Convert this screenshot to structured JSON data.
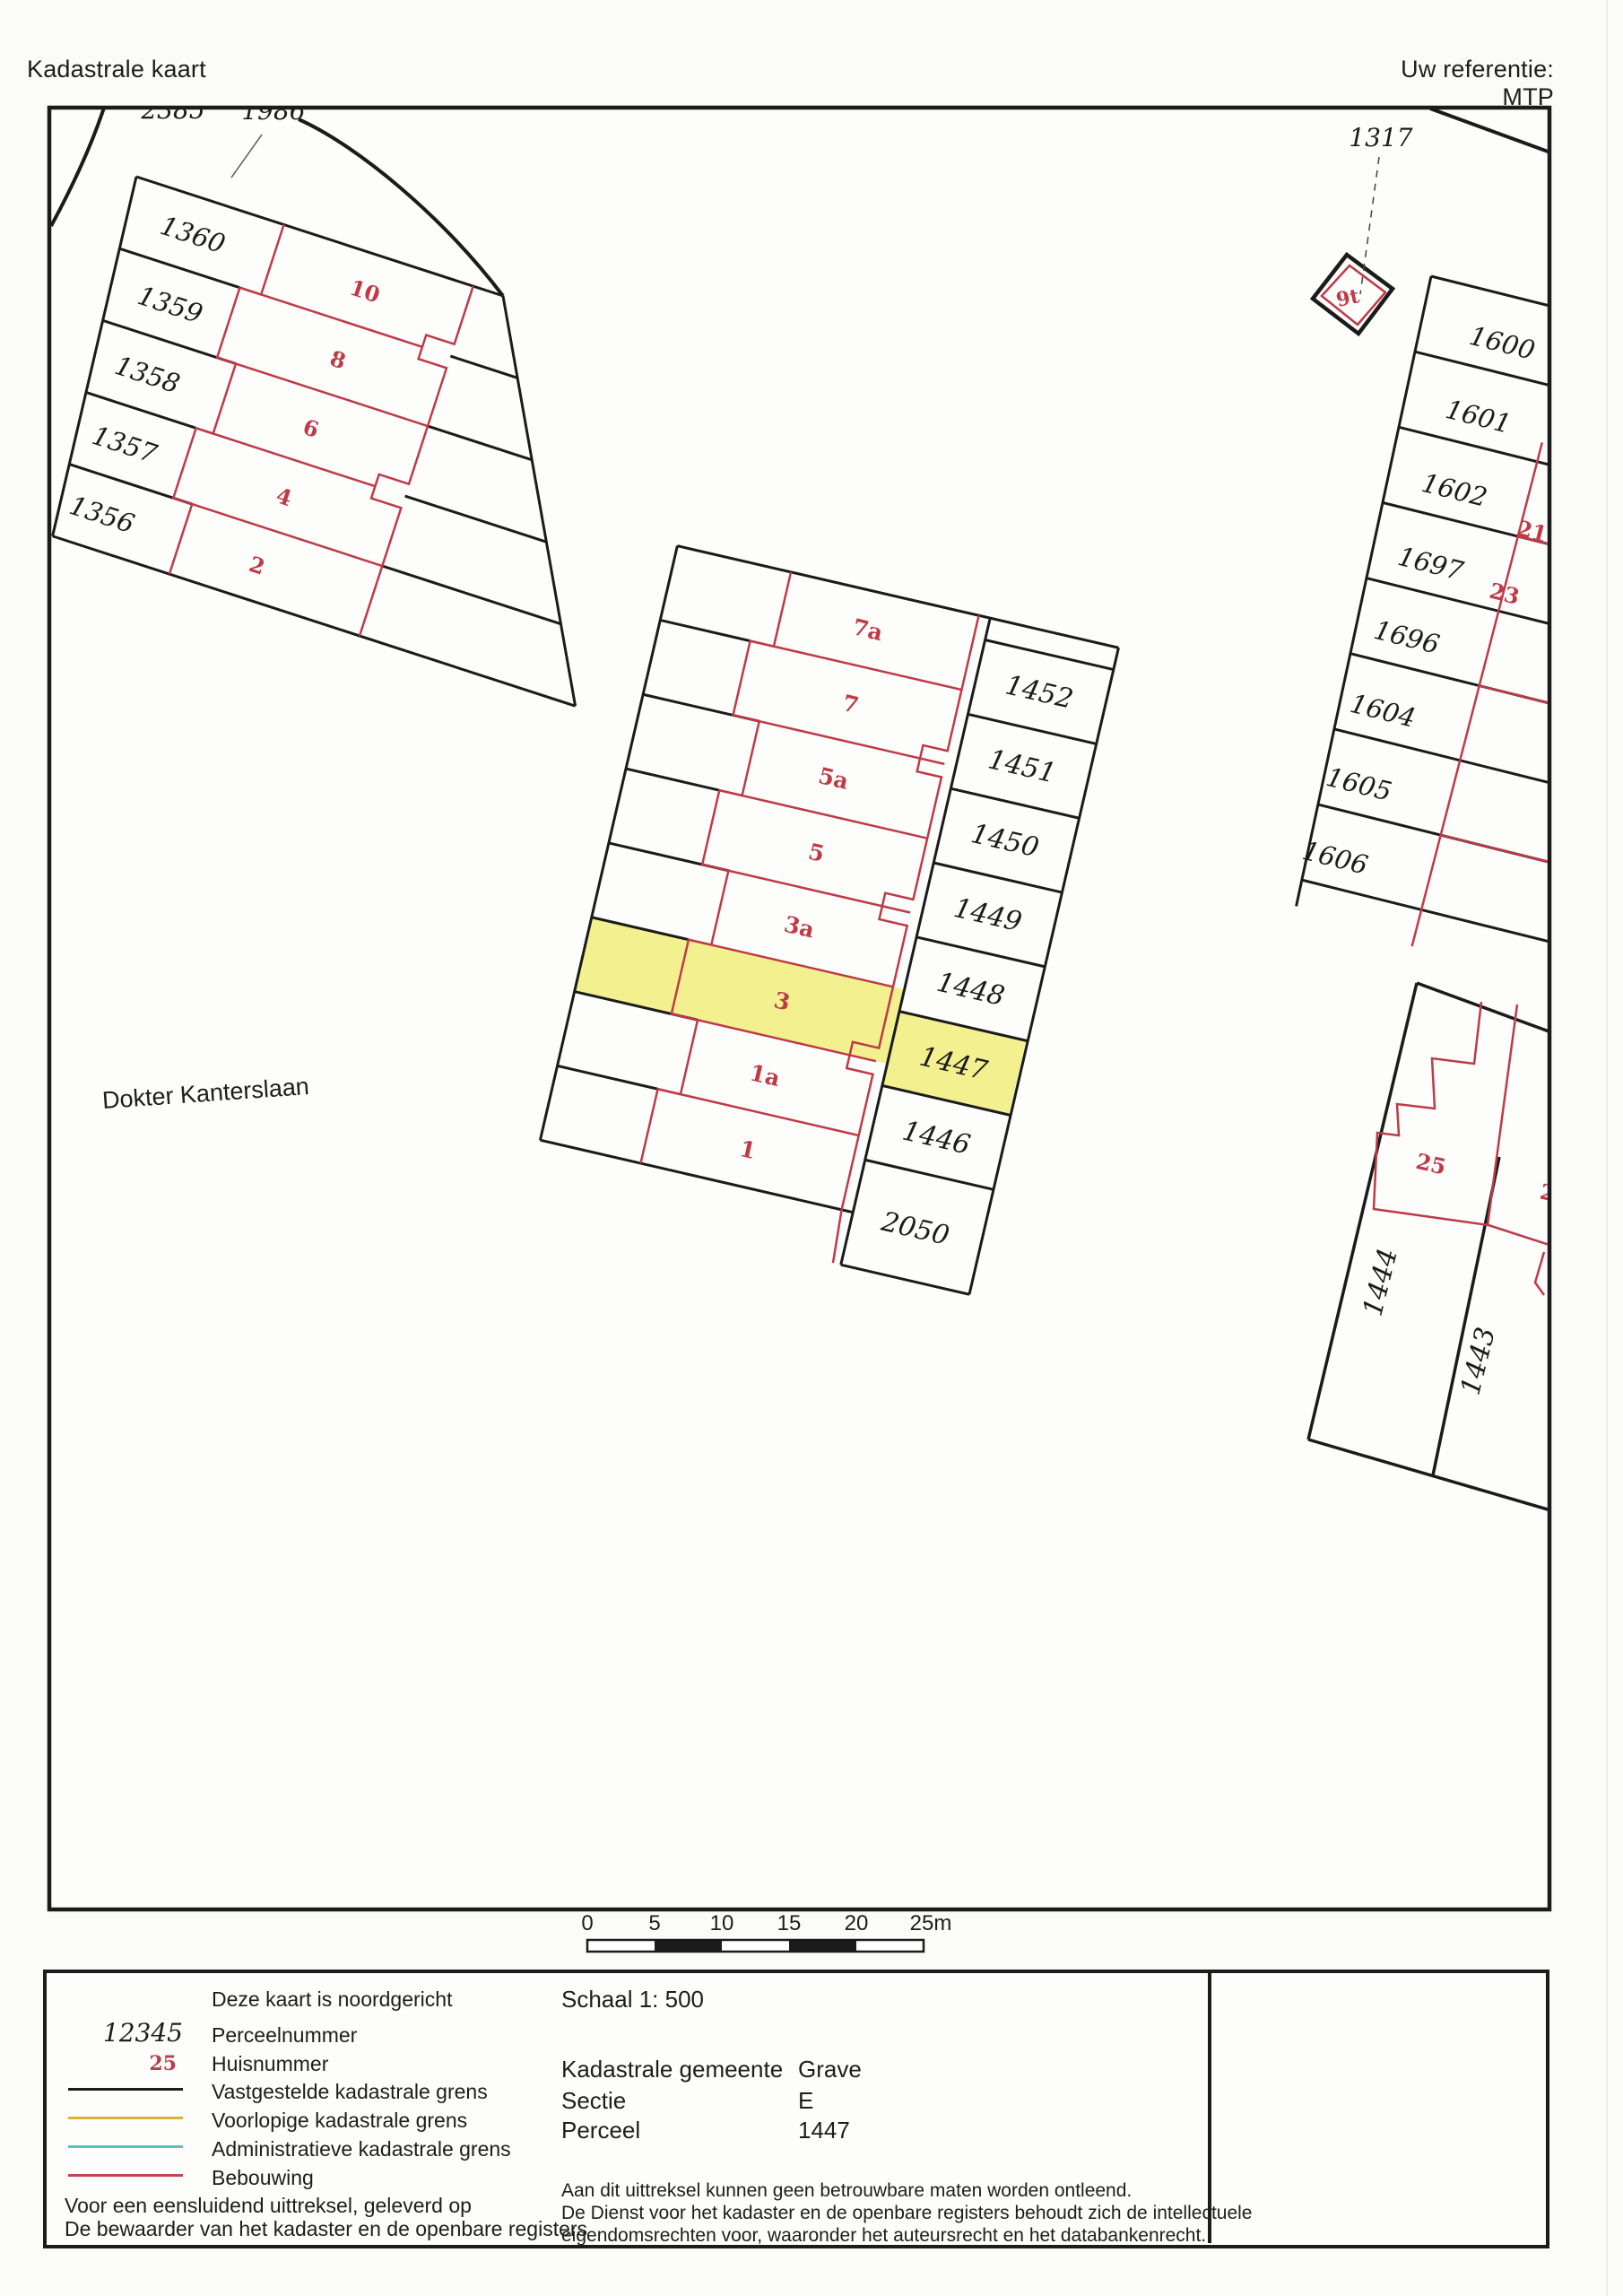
{
  "header": {
    "title": "Kadastrale kaart",
    "reference": "Uw referentie: MTP"
  },
  "map": {
    "street": "Dokter Kanterslaan",
    "parcels": {
      "p2385": "2385",
      "p1986": "1986",
      "p1360": "1360",
      "p1359": "1359",
      "p1358": "1358",
      "p1357": "1357",
      "p1356": "1356",
      "p1452": "1452",
      "p1451": "1451",
      "p1450": "1450",
      "p1449": "1449",
      "p1448": "1448",
      "p1447": "1447",
      "p1446": "1446",
      "p2050": "2050",
      "p1317": "1317",
      "p1600": "1600",
      "p1601": "1601",
      "p1602": "1602",
      "p1697": "1697",
      "p1696": "1696",
      "p1604": "1604",
      "p1605": "1605",
      "p1606": "1606",
      "p1444": "1444",
      "p1443": "1443"
    },
    "houses": {
      "h10": "10",
      "h8": "8",
      "h6": "6",
      "h4": "4",
      "h2": "2",
      "h7a": "7a",
      "h7": "7",
      "h5a": "5a",
      "h5": "5",
      "h3a": "3a",
      "h3": "3",
      "h1a": "1a",
      "h1": "1",
      "h9t": "9t",
      "h21": "21",
      "h23": "23",
      "h25": "25",
      "h25a": "25a"
    },
    "colors": {
      "boundary": "#1b1b1b",
      "building": "#bf3a47",
      "highlight": "#f3f08f"
    }
  },
  "scalebar": {
    "ticks": [
      "0",
      "5",
      "10",
      "15",
      "20",
      "25m"
    ]
  },
  "legend": {
    "north": "Deze kaart is noordgericht",
    "parcel_sample": "12345",
    "parcel_label": "Perceelnummer",
    "house_sample": "25",
    "house_label": "Huisnummer",
    "established": "Vastgestelde kadastrale grens",
    "provisional": "Voorlopige kadastrale grens",
    "administrative": "Administratieve kadastrale grens",
    "building": "Bebouwing",
    "footer1": "Voor een eensluidend uittreksel, geleverd op",
    "footer2": "De bewaarder van het kadaster en de openbare registers"
  },
  "info": {
    "scale": "Schaal 1: 500",
    "municipality_label": "Kadastrale gemeente",
    "municipality": "Grave",
    "section_label": "Sectie",
    "section": "E",
    "parcel_label": "Perceel",
    "parcel": "1447",
    "disclaimer1": "Aan dit uittreksel kunnen geen betrouwbare maten worden ontleend.",
    "disclaimer2": "De Dienst voor het kadaster en de openbare registers behoudt zich de intellectuele",
    "disclaimer3": "eigendomsrechten voor, waaronder het auteursrecht en het databankenrecht."
  },
  "logo": {
    "text": "kadaster"
  }
}
